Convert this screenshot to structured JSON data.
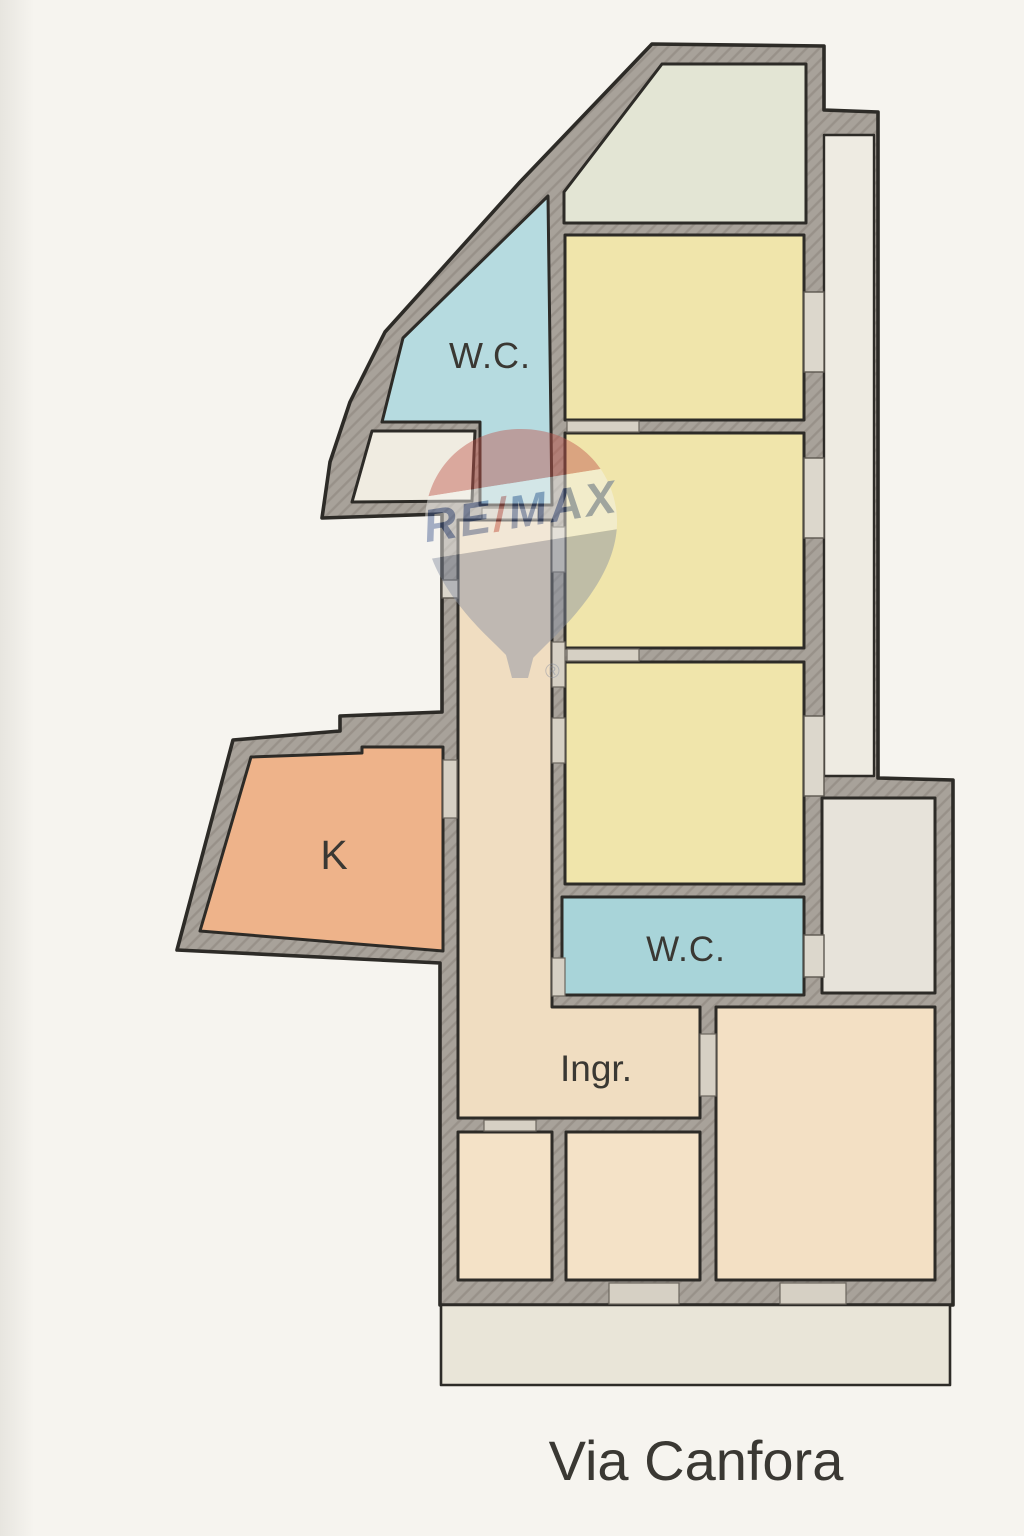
{
  "plan": {
    "street_label": "Via Canfora",
    "type": "apartment-floorplan"
  },
  "watermark": {
    "brand_left": "RE",
    "brand_slash": "/",
    "brand_right": "MAX",
    "registered": "®",
    "colors": {
      "red": "#c0564d",
      "blue": "#40598f",
      "balloon_body": "#848da0",
      "band": "#f6f5f1"
    }
  },
  "walls": {
    "fill": "#a8a29a",
    "hatch": "#968f86",
    "outline": "#2d2b27",
    "door_opening_fill": "#d6d0c4",
    "window_fill": "#dcd7cc"
  },
  "rooms": {
    "room_top": {
      "fill": "#e3e5d4"
    },
    "bedroom_1": {
      "fill": "#f0e5ab"
    },
    "bedroom_2": {
      "fill": "#f0e5ab"
    },
    "bedroom_3": {
      "fill": "#f0e5ab"
    },
    "wc_top": {
      "label": "W.C.",
      "fill": "#b6dbe0"
    },
    "wc_mid": {
      "label": "W.C.",
      "fill": "#a8d4d9"
    },
    "kitchen": {
      "label": "K",
      "fill": "#eeb38a"
    },
    "hall": {
      "label": "Ingr.",
      "fill": "#f0ddc1"
    },
    "closet": {
      "fill": "#f0ece1"
    },
    "storage": {
      "fill": "#e7e3da"
    },
    "living_room": {
      "fill": "#f3e0c4"
    },
    "room_bottom_1": {
      "fill": "#f4e2c7"
    },
    "room_bottom_2": {
      "fill": "#f4e2c7"
    },
    "balcony_right": {
      "fill": "#eeebe2"
    },
    "balcony_bottom": {
      "fill": "#e9e5d8"
    }
  },
  "labels": {
    "text_color": "#3a3833"
  }
}
